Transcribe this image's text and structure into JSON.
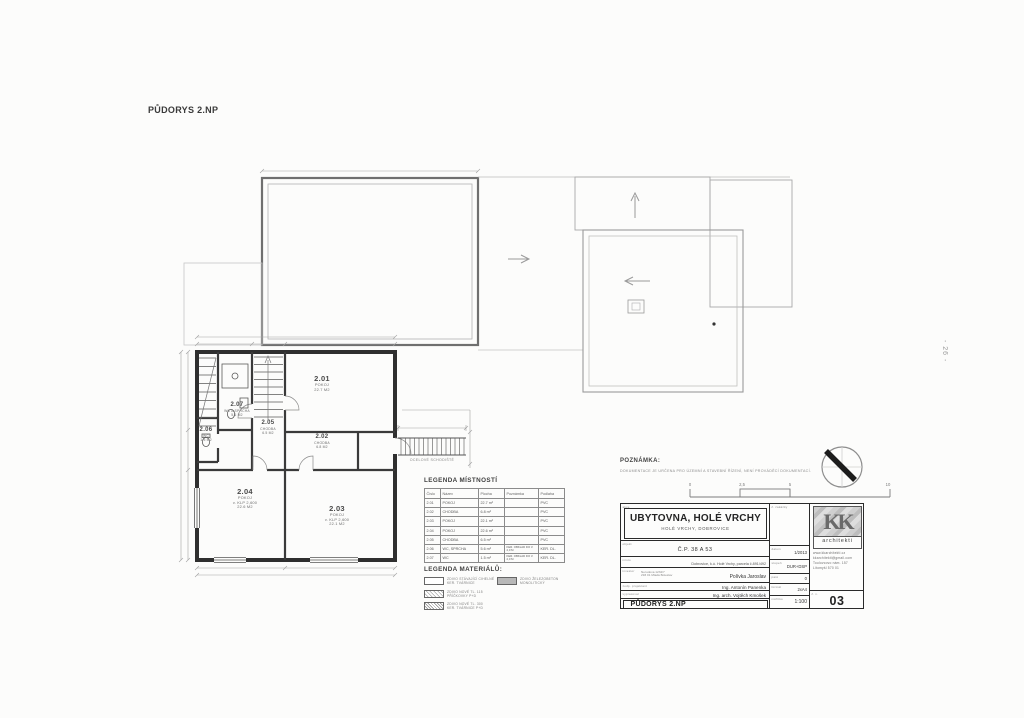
{
  "page": {
    "title": "PŮDORYS 2.NP",
    "side_note": "- 26 -"
  },
  "plan": {
    "rooms": [
      {
        "id": "2.01",
        "name": "POKOJ",
        "area": "22.7 M2",
        "note": ""
      },
      {
        "id": "2.02",
        "name": "CHODBA",
        "area": "6.8 M2",
        "note": ""
      },
      {
        "id": "2.03",
        "name": "POKOJ",
        "area": "22.1 M2",
        "note": "v. KLP 2,600"
      },
      {
        "id": "2.04",
        "name": "POKOJ",
        "area": "22.6 M2",
        "note": "v. KLP 2,600"
      },
      {
        "id": "2.05",
        "name": "CHODBA",
        "area": "6.5 M2",
        "note": ""
      },
      {
        "id": "2.06",
        "name": "WC",
        "area": "1.5 M2",
        "note": ""
      },
      {
        "id": "2.07",
        "name": "WC A SPRCHA",
        "area": "5.6 M2",
        "note": ""
      }
    ],
    "steel_stair_label": "OCELOVÉ SCHODIŠTĚ"
  },
  "legend_rooms": {
    "title": "LEGENDA MÍSTNOSTÍ",
    "headers": [
      "Číslo",
      "Název",
      "Plocha",
      "Poznámka",
      "Podlaha"
    ],
    "rows": [
      [
        "2.01",
        "POKOJ",
        "22.7 m²",
        "",
        "PVC"
      ],
      [
        "2.02",
        "CHODBA",
        "6.8 m²",
        "",
        "PVC"
      ],
      [
        "2.03",
        "POKOJ",
        "22.1 m²",
        "",
        "PVC"
      ],
      [
        "2.04",
        "POKOJ",
        "22.6 m²",
        "",
        "PVC"
      ],
      [
        "2.05",
        "CHODBA",
        "6.5 m²",
        "",
        "PVC"
      ],
      [
        "2.06",
        "WC, SPRCHA",
        "5.6 m²",
        "KER. OBKLAD DO V. 2,0 M",
        "KER. DL."
      ],
      [
        "2.07",
        "WC",
        "1.5 m²",
        "KER. OBKLAD DO V. 2,0 M",
        "KER. DL."
      ]
    ]
  },
  "legend_materials": {
    "title": "LEGENDA MATERIÁLŮ:",
    "items": [
      {
        "lines": [
          "ZDIVO STÁVAJÍCÍ CIHELNÉ",
          "KER. TVÁRNICE"
        ]
      },
      {
        "lines": [
          "ZDIVO NOVÉ TL. 115",
          "PŘÍČKOVKY P+D"
        ]
      },
      {
        "lines": [
          "ZDIVO NOVÉ TL. 300",
          "KER. TVÁRNICE P+D"
        ]
      },
      {
        "lines": [
          "ZDIVO ŽELEZOBETON",
          "MONOLITICKÝ"
        ]
      }
    ]
  },
  "note": {
    "title": "POZNÁMKA:",
    "text": "DOKUMENTACE JE URČENA PRO ÚZEMNÍ A STAVEBNÍ ŘÍZENÍ, NENÍ PROVÁDĚCÍ DOKUMENTACÍ."
  },
  "scale_bar": {
    "labels": [
      "0",
      "2,5",
      "5",
      "10"
    ]
  },
  "titleblock": {
    "labels": {
      "akce": "akce",
      "objekt": "objekt",
      "misto": "místo",
      "investor": "investor",
      "projektant": "zodp. projektant",
      "vypracoval": "vypracoval",
      "obsah": "obsah",
      "zakazka": "č. zakázky",
      "datum": "datum",
      "stupen": "stupeň",
      "pare": "paré",
      "format": "formát",
      "meritko": "měřítko",
      "cislo": "č. v."
    },
    "akce_title": "UBYTOVNA, HOLÉ VRCHY",
    "akce_sub": "HOLÉ VRCHY, DOBROVICE",
    "objekt": "Č.P. 38 A 53",
    "misto": "Dobrovice, k.ú. Holé Vrchy, parcela č.891/492",
    "investor_addr1": "Nerudova 1234/7",
    "investor_addr2": "293 01 Mladá Boleslav",
    "investor_name": "Polívka Jaroslav",
    "projektant": "Ing. Antonín Panenka",
    "vypracoval": "Ing. arch. Vojtěch Kmošek",
    "obsah": "PŮDORYS 2.NP",
    "datum": "1/2013",
    "stupen": "DUR+DSP",
    "pare": "0",
    "format": "2xA4",
    "meritko": "1:100",
    "cislo": "03",
    "logo": {
      "text": "KK",
      "sub": "architekti",
      "line1": "www.kkarchitekti.cz",
      "line2": "kkarchitekti@gmail.com",
      "line3": "Toulovcovo nám. 157",
      "line4": "Litomyšl 570 01"
    }
  }
}
